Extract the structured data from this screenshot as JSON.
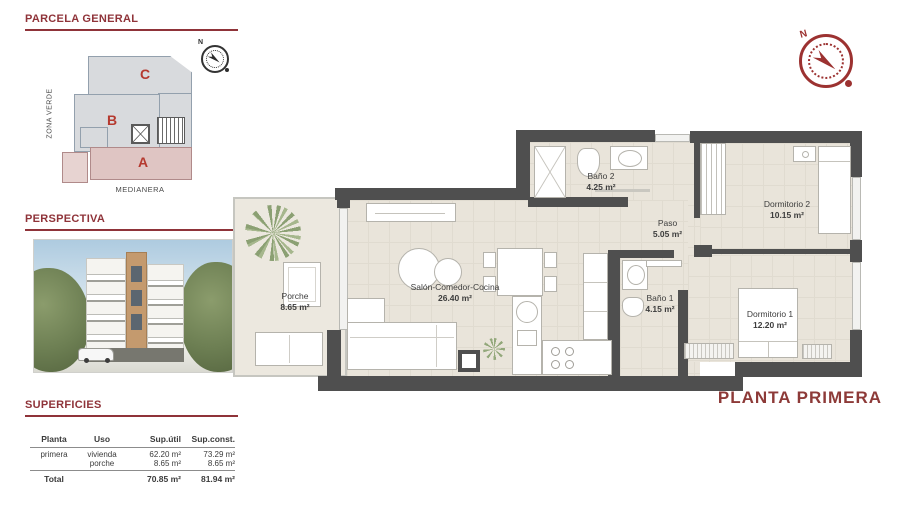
{
  "sections": {
    "parcela": {
      "title": "PARCELA GENERAL"
    },
    "perspectiva": {
      "title": "PERSPECTIVA"
    },
    "superficies": {
      "title": "SUPERFICIES"
    }
  },
  "site_plan": {
    "block_a": "A",
    "block_b": "B",
    "block_c": "C",
    "zona_verde": "ZONA VERDE",
    "medianera": "MEDIANERA"
  },
  "table": {
    "headers": {
      "planta": "Planta",
      "uso": "Uso",
      "sup_util": "Sup.útil",
      "sup_const": "Sup.const."
    },
    "row1": {
      "planta": "primera",
      "uso1": "vivienda",
      "uso2": "porche",
      "util1": "62.20 m²",
      "util2": "8.65 m²",
      "const1": "73.29 m²",
      "const2": "8.65 m²"
    },
    "total": {
      "label": "Total",
      "util": "70.85 m²",
      "const": "81.94 m²"
    }
  },
  "plan": {
    "title": "PLANTA PRIMERA",
    "compass_n": "N",
    "rooms": {
      "porche": {
        "name": "Porche",
        "area": "8.65 m²"
      },
      "salon": {
        "name": "Salón-Comedor-Cocina",
        "area": "26.40 m²"
      },
      "bano2": {
        "name": "Baño 2",
        "area": "4.25 m²"
      },
      "paso": {
        "name": "Paso",
        "area": "5.05 m²"
      },
      "dorm2": {
        "name": "Dormitorio 2",
        "area": "10.15 m²"
      },
      "bano1": {
        "name": "Baño 1",
        "area": "4.15 m²"
      },
      "dorm1": {
        "name": "Dormitorio 1",
        "area": "12.20 m²"
      }
    }
  },
  "colors": {
    "accent_red": "#8f3339",
    "wall_gray": "#4f4f4f",
    "floor_beige": "#e9e4da",
    "block_gray": "#d8dadd",
    "block_pink": "#dfc5c3",
    "letter_red": "#b5392f"
  }
}
